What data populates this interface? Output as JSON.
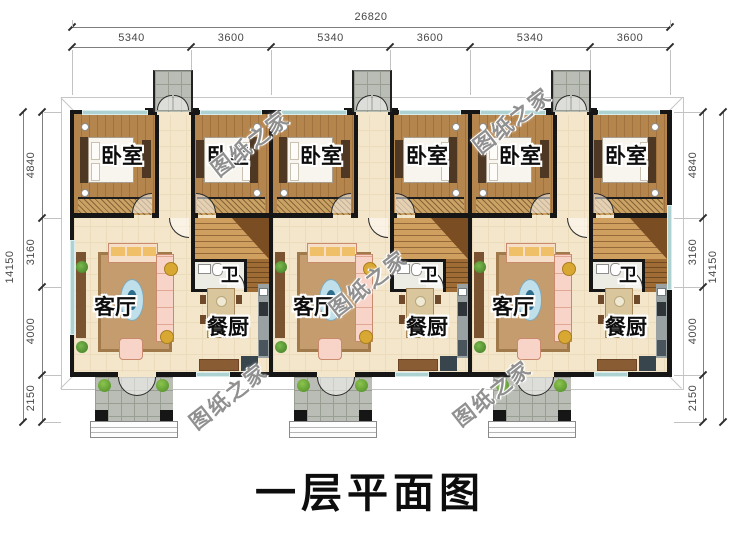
{
  "title": "一层平面图",
  "watermark": {
    "text": "图纸之家"
  },
  "dimensions": {
    "top": {
      "total": "26820",
      "segments": [
        "5340",
        "3600",
        "5340",
        "3600",
        "5340",
        "3600"
      ]
    },
    "left": {
      "total": "14150",
      "segments": [
        "4840",
        "3160",
        "4000",
        "2150"
      ]
    },
    "right": {
      "total": "14150",
      "segments": [
        "4840",
        "3160",
        "4000",
        "2150"
      ]
    }
  },
  "rooms": {
    "bedroom": "卧室",
    "living_room": "客厅",
    "bathroom": "卫",
    "dining_kitchen": "餐厨"
  },
  "colors": {
    "wall": "#161616",
    "wood_floor": "#b5854e",
    "tile_floor": "#f4e6ca",
    "window": "#aed2d2",
    "porch_stone": "#babdb5",
    "title_text": "#0d0d0d"
  }
}
